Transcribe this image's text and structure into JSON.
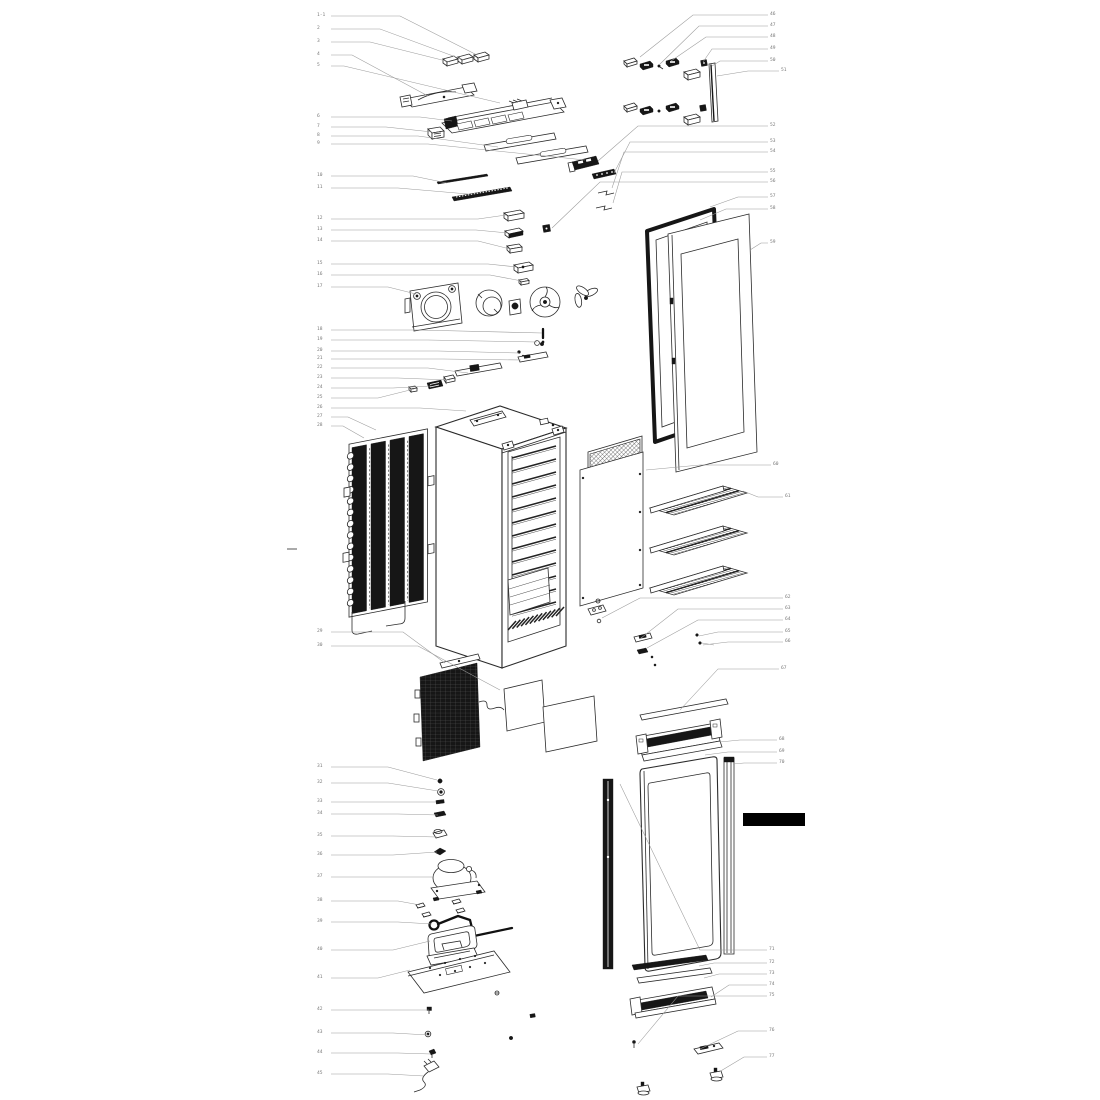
{
  "palette": {
    "background": "#ffffff",
    "line": "#2b2b2b",
    "dark_fill": "#161616",
    "leader_line": "#9a9a9a",
    "label_text": "#787878",
    "redaction": "#000000"
  },
  "redaction_bar": {
    "x": 743,
    "y": 813,
    "w": 62,
    "h": 13
  },
  "margin_tick": {
    "x1": 287,
    "y1": 549,
    "x2": 297,
    "y2": 549
  },
  "callouts": [
    {
      "n": "1-1",
      "x": 317,
      "y": 13,
      "pts": [
        [
          331,
          16
        ],
        [
          400,
          16
        ],
        [
          477,
          55
        ]
      ]
    },
    {
      "n": "2",
      "x": 317,
      "y": 26,
      "pts": [
        [
          331,
          29
        ],
        [
          380,
          29
        ],
        [
          464,
          60
        ]
      ]
    },
    {
      "n": "3",
      "x": 317,
      "y": 39,
      "pts": [
        [
          331,
          42
        ],
        [
          370,
          42
        ],
        [
          450,
          62
        ]
      ]
    },
    {
      "n": "4",
      "x": 317,
      "y": 52,
      "pts": [
        [
          331,
          55
        ],
        [
          352,
          55
        ],
        [
          428,
          96
        ]
      ]
    },
    {
      "n": "5",
      "x": 317,
      "y": 63,
      "pts": [
        [
          331,
          66
        ],
        [
          344,
          66
        ],
        [
          500,
          103
        ]
      ]
    },
    {
      "n": "6",
      "x": 317,
      "y": 114,
      "pts": [
        [
          331,
          117
        ],
        [
          420,
          117
        ],
        [
          452,
          121
        ]
      ]
    },
    {
      "n": "7",
      "x": 317,
      "y": 124,
      "pts": [
        [
          331,
          127
        ],
        [
          386,
          127
        ],
        [
          432,
          132
        ]
      ]
    },
    {
      "n": "8",
      "x": 317,
      "y": 133,
      "pts": [
        [
          331,
          136
        ],
        [
          418,
          136
        ],
        [
          498,
          147
        ]
      ]
    },
    {
      "n": "9",
      "x": 317,
      "y": 141,
      "pts": [
        [
          331,
          144
        ],
        [
          428,
          144
        ],
        [
          585,
          160
        ]
      ]
    },
    {
      "n": "10",
      "x": 317,
      "y": 173,
      "pts": [
        [
          331,
          176
        ],
        [
          413,
          176
        ],
        [
          447,
          183
        ]
      ]
    },
    {
      "n": "11",
      "x": 317,
      "y": 185,
      "pts": [
        [
          331,
          188
        ],
        [
          398,
          188
        ],
        [
          468,
          194
        ]
      ]
    },
    {
      "n": "12",
      "x": 317,
      "y": 216,
      "pts": [
        [
          331,
          219
        ],
        [
          478,
          219
        ],
        [
          506,
          215
        ]
      ]
    },
    {
      "n": "13",
      "x": 317,
      "y": 227,
      "pts": [
        [
          331,
          230
        ],
        [
          476,
          230
        ],
        [
          508,
          233
        ]
      ]
    },
    {
      "n": "14",
      "x": 317,
      "y": 238,
      "pts": [
        [
          331,
          241
        ],
        [
          478,
          241
        ],
        [
          510,
          249
        ]
      ]
    },
    {
      "n": "15",
      "x": 317,
      "y": 261,
      "pts": [
        [
          331,
          264
        ],
        [
          488,
          264
        ],
        [
          517,
          267
        ]
      ]
    },
    {
      "n": "16",
      "x": 317,
      "y": 272,
      "pts": [
        [
          331,
          275
        ],
        [
          490,
          275
        ],
        [
          522,
          281
        ]
      ]
    },
    {
      "n": "17",
      "x": 317,
      "y": 284,
      "pts": [
        [
          331,
          287
        ],
        [
          388,
          287
        ],
        [
          416,
          294
        ]
      ]
    },
    {
      "n": "18",
      "x": 317,
      "y": 327,
      "pts": [
        [
          331,
          330
        ],
        [
          418,
          330
        ],
        [
          542,
          333
        ]
      ]
    },
    {
      "n": "19",
      "x": 317,
      "y": 337,
      "pts": [
        [
          331,
          340
        ],
        [
          428,
          340
        ],
        [
          537,
          342
        ]
      ]
    },
    {
      "n": "20",
      "x": 317,
      "y": 348,
      "pts": [
        [
          331,
          351
        ],
        [
          438,
          351
        ],
        [
          519,
          353
        ]
      ]
    },
    {
      "n": "21",
      "x": 317,
      "y": 356,
      "pts": [
        [
          331,
          359
        ],
        [
          443,
          359
        ],
        [
          521,
          360
        ]
      ]
    },
    {
      "n": "22",
      "x": 317,
      "y": 365,
      "pts": [
        [
          331,
          368
        ],
        [
          428,
          368
        ],
        [
          468,
          373
        ]
      ]
    },
    {
      "n": "23",
      "x": 317,
      "y": 375,
      "pts": [
        [
          331,
          378
        ],
        [
          398,
          378
        ],
        [
          450,
          380
        ]
      ]
    },
    {
      "n": "24",
      "x": 317,
      "y": 385,
      "pts": [
        [
          331,
          388
        ],
        [
          393,
          388
        ],
        [
          431,
          386
        ]
      ]
    },
    {
      "n": "25",
      "x": 317,
      "y": 395,
      "pts": [
        [
          331,
          398
        ],
        [
          378,
          398
        ],
        [
          414,
          389
        ]
      ]
    },
    {
      "n": "26",
      "x": 317,
      "y": 405,
      "pts": [
        [
          331,
          408
        ],
        [
          420,
          408
        ],
        [
          466,
          411
        ]
      ]
    },
    {
      "n": "27",
      "x": 317,
      "y": 414,
      "pts": [
        [
          331,
          417
        ],
        [
          348,
          417
        ],
        [
          376,
          430
        ]
      ]
    },
    {
      "n": "28",
      "x": 317,
      "y": 423,
      "pts": [
        [
          331,
          426
        ],
        [
          343,
          426
        ],
        [
          364,
          438
        ]
      ]
    },
    {
      "n": "29",
      "x": 317,
      "y": 629,
      "pts": [
        [
          331,
          632
        ],
        [
          403,
          632
        ],
        [
          445,
          663
        ]
      ]
    },
    {
      "n": "30",
      "x": 317,
      "y": 643,
      "pts": [
        [
          331,
          646
        ],
        [
          418,
          646
        ],
        [
          500,
          690
        ]
      ]
    },
    {
      "n": "31",
      "x": 317,
      "y": 764,
      "pts": [
        [
          331,
          767
        ],
        [
          388,
          767
        ],
        [
          437,
          780
        ]
      ]
    },
    {
      "n": "32",
      "x": 317,
      "y": 780,
      "pts": [
        [
          331,
          783
        ],
        [
          388,
          783
        ],
        [
          438,
          791
        ]
      ]
    },
    {
      "n": "33",
      "x": 317,
      "y": 799,
      "pts": [
        [
          331,
          802
        ],
        [
          398,
          802
        ],
        [
          436,
          802
        ]
      ]
    },
    {
      "n": "34",
      "x": 317,
      "y": 811,
      "pts": [
        [
          331,
          814
        ],
        [
          398,
          814
        ],
        [
          438,
          815
        ]
      ]
    },
    {
      "n": "35",
      "x": 317,
      "y": 833,
      "pts": [
        [
          331,
          836
        ],
        [
          393,
          836
        ],
        [
          437,
          837
        ]
      ]
    },
    {
      "n": "36",
      "x": 317,
      "y": 852,
      "pts": [
        [
          331,
          855
        ],
        [
          393,
          855
        ],
        [
          437,
          852
        ]
      ]
    },
    {
      "n": "37",
      "x": 317,
      "y": 874,
      "pts": [
        [
          331,
          877
        ],
        [
          413,
          877
        ],
        [
          434,
          877
        ]
      ]
    },
    {
      "n": "38",
      "x": 317,
      "y": 898,
      "pts": [
        [
          331,
          901
        ],
        [
          398,
          901
        ],
        [
          420,
          905
        ]
      ]
    },
    {
      "n": "39",
      "x": 317,
      "y": 919,
      "pts": [
        [
          331,
          922
        ],
        [
          398,
          922
        ],
        [
          432,
          924
        ]
      ]
    },
    {
      "n": "40",
      "x": 317,
      "y": 947,
      "pts": [
        [
          331,
          950
        ],
        [
          393,
          950
        ],
        [
          430,
          941
        ]
      ]
    },
    {
      "n": "41",
      "x": 317,
      "y": 975,
      "pts": [
        [
          331,
          978
        ],
        [
          378,
          978
        ],
        [
          410,
          970
        ]
      ]
    },
    {
      "n": "42",
      "x": 317,
      "y": 1007,
      "pts": [
        [
          331,
          1010
        ],
        [
          398,
          1010
        ],
        [
          429,
          1010
        ]
      ]
    },
    {
      "n": "43",
      "x": 317,
      "y": 1030,
      "pts": [
        [
          331,
          1033
        ],
        [
          393,
          1033
        ],
        [
          428,
          1035
        ]
      ]
    },
    {
      "n": "44",
      "x": 317,
      "y": 1050,
      "pts": [
        [
          331,
          1053
        ],
        [
          398,
          1053
        ],
        [
          431,
          1054
        ]
      ]
    },
    {
      "n": "45",
      "x": 317,
      "y": 1071,
      "pts": [
        [
          331,
          1074
        ],
        [
          388,
          1074
        ],
        [
          424,
          1076
        ]
      ]
    },
    {
      "n": "46",
      "x": 770,
      "y": 12,
      "pts": [
        [
          768,
          15
        ],
        [
          693,
          15
        ],
        [
          640,
          57
        ]
      ]
    },
    {
      "n": "47",
      "x": 770,
      "y": 23,
      "pts": [
        [
          768,
          26
        ],
        [
          699,
          26
        ],
        [
          659,
          65
        ]
      ]
    },
    {
      "n": "48",
      "x": 770,
      "y": 34,
      "pts": [
        [
          768,
          37
        ],
        [
          706,
          37
        ],
        [
          671,
          61
        ]
      ]
    },
    {
      "n": "49",
      "x": 770,
      "y": 46,
      "pts": [
        [
          768,
          49
        ],
        [
          712,
          49
        ],
        [
          703,
          62
        ]
      ]
    },
    {
      "n": "50",
      "x": 770,
      "y": 58,
      "pts": [
        [
          768,
          61
        ],
        [
          720,
          61
        ],
        [
          712,
          66
        ]
      ]
    },
    {
      "n": "51",
      "x": 781,
      "y": 68,
      "pts": [
        [
          779,
          71
        ],
        [
          748,
          71
        ],
        [
          717,
          76
        ]
      ]
    },
    {
      "n": "52",
      "x": 770,
      "y": 123,
      "pts": [
        [
          768,
          126
        ],
        [
          638,
          126
        ],
        [
          598,
          161
        ]
      ]
    },
    {
      "n": "53",
      "x": 770,
      "y": 139,
      "pts": [
        [
          768,
          142
        ],
        [
          630,
          142
        ],
        [
          614,
          173
        ]
      ]
    },
    {
      "n": "54",
      "x": 770,
      "y": 149,
      "pts": [
        [
          768,
          152
        ],
        [
          624,
          152
        ],
        [
          612,
          188
        ]
      ]
    },
    {
      "n": "55",
      "x": 770,
      "y": 169,
      "pts": [
        [
          768,
          172
        ],
        [
          622,
          172
        ],
        [
          613,
          203
        ]
      ]
    },
    {
      "n": "56",
      "x": 770,
      "y": 179,
      "pts": [
        [
          768,
          182
        ],
        [
          600,
          182
        ],
        [
          552,
          228
        ]
      ]
    },
    {
      "n": "57",
      "x": 770,
      "y": 194,
      "pts": [
        [
          768,
          197
        ],
        [
          738,
          197
        ],
        [
          710,
          207
        ]
      ]
    },
    {
      "n": "58",
      "x": 770,
      "y": 206,
      "pts": [
        [
          768,
          209
        ],
        [
          726,
          209
        ],
        [
          700,
          220
        ]
      ]
    },
    {
      "n": "59",
      "x": 770,
      "y": 240,
      "pts": [
        [
          768,
          243
        ],
        [
          761,
          243
        ],
        [
          750,
          250
        ]
      ]
    },
    {
      "n": "60",
      "x": 773,
      "y": 462,
      "pts": [
        [
          771,
          465
        ],
        [
          700,
          465
        ],
        [
          646,
          470
        ]
      ]
    },
    {
      "n": "61",
      "x": 785,
      "y": 494,
      "pts": [
        [
          783,
          497
        ],
        [
          758,
          497
        ],
        [
          743,
          491
        ]
      ]
    },
    {
      "n": "62",
      "x": 785,
      "y": 595,
      "pts": [
        [
          783,
          598
        ],
        [
          640,
          598
        ],
        [
          602,
          618
        ]
      ]
    },
    {
      "n": "63",
      "x": 785,
      "y": 606,
      "pts": [
        [
          783,
          609
        ],
        [
          678,
          609
        ],
        [
          641,
          638
        ]
      ]
    },
    {
      "n": "64",
      "x": 785,
      "y": 617,
      "pts": [
        [
          783,
          620
        ],
        [
          698,
          620
        ],
        [
          647,
          648
        ]
      ]
    },
    {
      "n": "65",
      "x": 785,
      "y": 629,
      "pts": [
        [
          783,
          632
        ],
        [
          718,
          632
        ],
        [
          699,
          636
        ]
      ]
    },
    {
      "n": "66",
      "x": 785,
      "y": 639,
      "pts": [
        [
          783,
          642
        ],
        [
          728,
          642
        ],
        [
          703,
          645
        ]
      ]
    },
    {
      "n": "67",
      "x": 781,
      "y": 666,
      "pts": [
        [
          779,
          669
        ],
        [
          718,
          669
        ],
        [
          680,
          710
        ]
      ]
    },
    {
      "n": "68",
      "x": 779,
      "y": 737,
      "pts": [
        [
          777,
          740
        ],
        [
          740,
          740
        ],
        [
          720,
          742
        ]
      ]
    },
    {
      "n": "69",
      "x": 779,
      "y": 749,
      "pts": [
        [
          777,
          752
        ],
        [
          728,
          752
        ],
        [
          705,
          755
        ]
      ]
    },
    {
      "n": "70",
      "x": 779,
      "y": 760,
      "pts": [
        [
          777,
          763
        ],
        [
          744,
          763
        ],
        [
          733,
          764
        ]
      ]
    },
    {
      "n": "71",
      "x": 769,
      "y": 947,
      "pts": [
        [
          767,
          950
        ],
        [
          700,
          950
        ],
        [
          620,
          784
        ]
      ]
    },
    {
      "n": "72",
      "x": 769,
      "y": 960,
      "pts": [
        [
          767,
          963
        ],
        [
          714,
          963
        ],
        [
          699,
          966
        ]
      ]
    },
    {
      "n": "73",
      "x": 769,
      "y": 971,
      "pts": [
        [
          767,
          974
        ],
        [
          719,
          974
        ],
        [
          704,
          978
        ]
      ]
    },
    {
      "n": "74",
      "x": 769,
      "y": 982,
      "pts": [
        [
          767,
          985
        ],
        [
          729,
          985
        ],
        [
          711,
          997
        ]
      ]
    },
    {
      "n": "75",
      "x": 769,
      "y": 993,
      "pts": [
        [
          767,
          996
        ],
        [
          678,
          996
        ],
        [
          638,
          1044
        ]
      ]
    },
    {
      "n": "76",
      "x": 769,
      "y": 1028,
      "pts": [
        [
          767,
          1031
        ],
        [
          738,
          1031
        ],
        [
          700,
          1049
        ]
      ]
    },
    {
      "n": "77",
      "x": 769,
      "y": 1054,
      "pts": [
        [
          767,
          1057
        ],
        [
          744,
          1057
        ],
        [
          719,
          1072
        ]
      ]
    }
  ],
  "shelves": {
    "count": 3,
    "origin_x": 650,
    "origin_y": 481,
    "dy": 40
  }
}
